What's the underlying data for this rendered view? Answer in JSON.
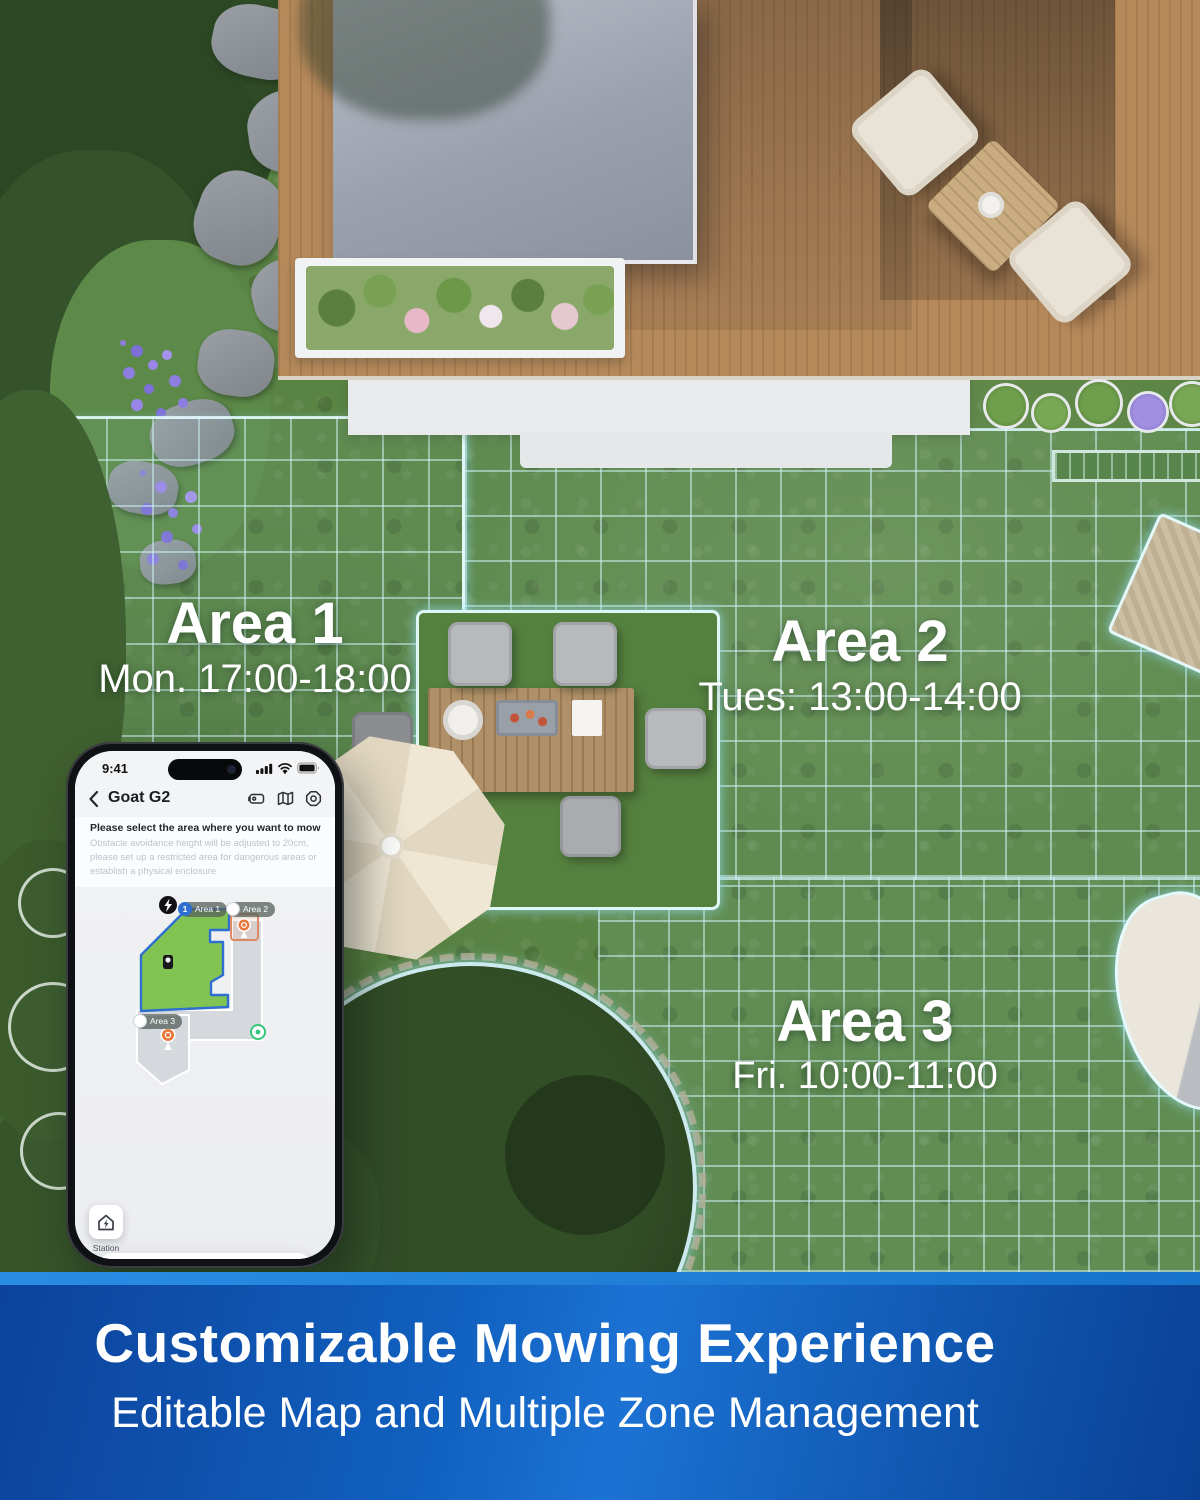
{
  "scene": {
    "areas": [
      {
        "name": "Area 1",
        "schedule": "Mon. 17:00-18:00"
      },
      {
        "name": "Area 2",
        "schedule": "Tues: 13:00-14:00"
      },
      {
        "name": "Area 3",
        "schedule": "Fri. 10:00-11:00"
      }
    ]
  },
  "phone": {
    "status": {
      "time": "9:41"
    },
    "nav": {
      "title": "Goat G2"
    },
    "instruction": {
      "title": "Please select the area where you want to mow",
      "subtitle": "Obstacle avoidance height will be adjusted to 20cm, please set up a restricted area for dangerous areas or establish a physical enclosure"
    },
    "map": {
      "area1_label": "Area 1",
      "area1_index": "1",
      "area2_label": "Area 2",
      "area3_label": "Area 3"
    },
    "station_label": "Station",
    "controls": {
      "mode": "Enhanced",
      "battery": "60%",
      "start_label": "Start"
    }
  },
  "banner": {
    "title": "Customizable Mowing Experience",
    "subtitle": "Editable Map and Multiple Zone Management"
  },
  "colors": {
    "banner_blue": "#1161c0",
    "grid_cyan": "#cdeff5",
    "map_area_green": "#82c454",
    "map_border_blue": "#2e6fd0",
    "battery_green": "#34c759",
    "pin_orange": "#e8793e",
    "start_button_navy": "#1f2f45"
  }
}
